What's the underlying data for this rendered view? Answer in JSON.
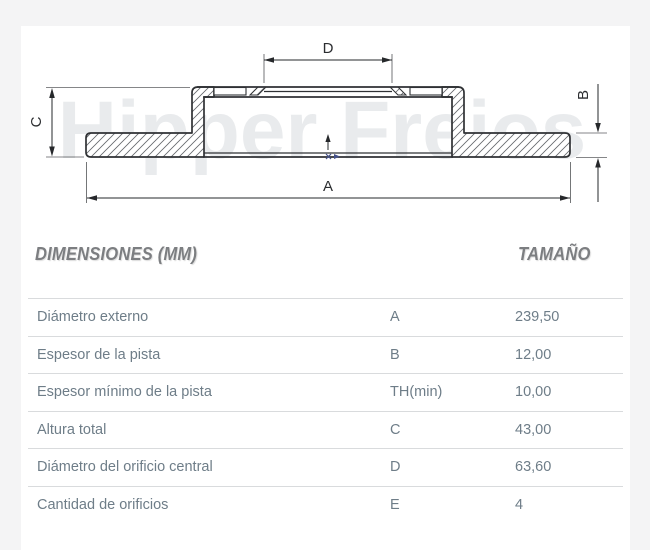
{
  "watermark": "Hipper Freios",
  "diagram": {
    "labels": {
      "bottom": "A",
      "right": "B",
      "left": "C",
      "top": "D"
    }
  },
  "table": {
    "header": {
      "dimensions": "DIMENSIONES (MM)",
      "size": "TAMAÑO"
    },
    "rows": [
      {
        "label": "Diámetro externo",
        "letter": "A",
        "value": "239,50"
      },
      {
        "label": "Espesor de la pista",
        "letter": "B",
        "value": "12,00"
      },
      {
        "label": "Espesor mínimo de la pista",
        "letter": "TH(min)",
        "value": "10,00"
      },
      {
        "label": "Altura total",
        "letter": "C",
        "value": "43,00"
      },
      {
        "label": "Diámetro del orificio central",
        "letter": "D",
        "value": "63,60"
      },
      {
        "label": "Cantidad de orificios",
        "letter": "E",
        "value": "4"
      }
    ]
  },
  "colors": {
    "page-bg": "#f4f4f5",
    "card-bg": "#ffffff",
    "line": "#2f3134",
    "dim": "#26282b",
    "accent": "#44518a",
    "watermark": "#e9ebed",
    "header-text": "#7c7e81",
    "table-text": "#6e7d88",
    "rule": "#d9dbdd"
  }
}
